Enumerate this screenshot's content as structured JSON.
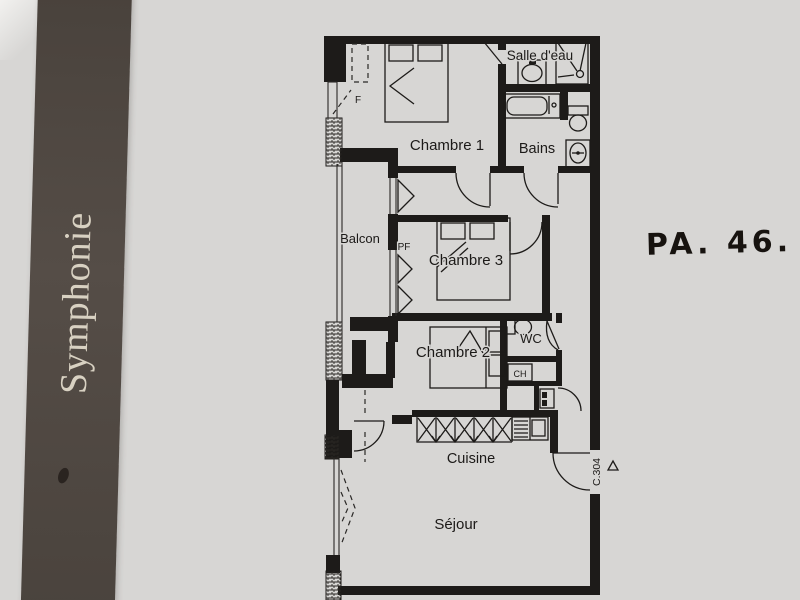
{
  "page": {
    "band_title": "Symphonie",
    "annotation": "PA. 46."
  },
  "plan": {
    "labels": {
      "salle_deau": "Salle d'eau",
      "chambre1": "Chambre 1",
      "bains": "Bains",
      "balcon": "Balcon",
      "pf": "PF",
      "f": "F",
      "chambre3": "Chambre 3",
      "wc": "WC",
      "ch": "CH",
      "chambre2": "Chambre 2",
      "cuisine": "Cuisine",
      "sejour": "Séjour",
      "unit_door": "C.304"
    },
    "colors": {
      "paper": "#d7d6d4",
      "wall_ink": "#1d1b19",
      "band": "#4d4540",
      "band_text": "#d8d1c2",
      "marker_ink": "#17130f"
    }
  }
}
